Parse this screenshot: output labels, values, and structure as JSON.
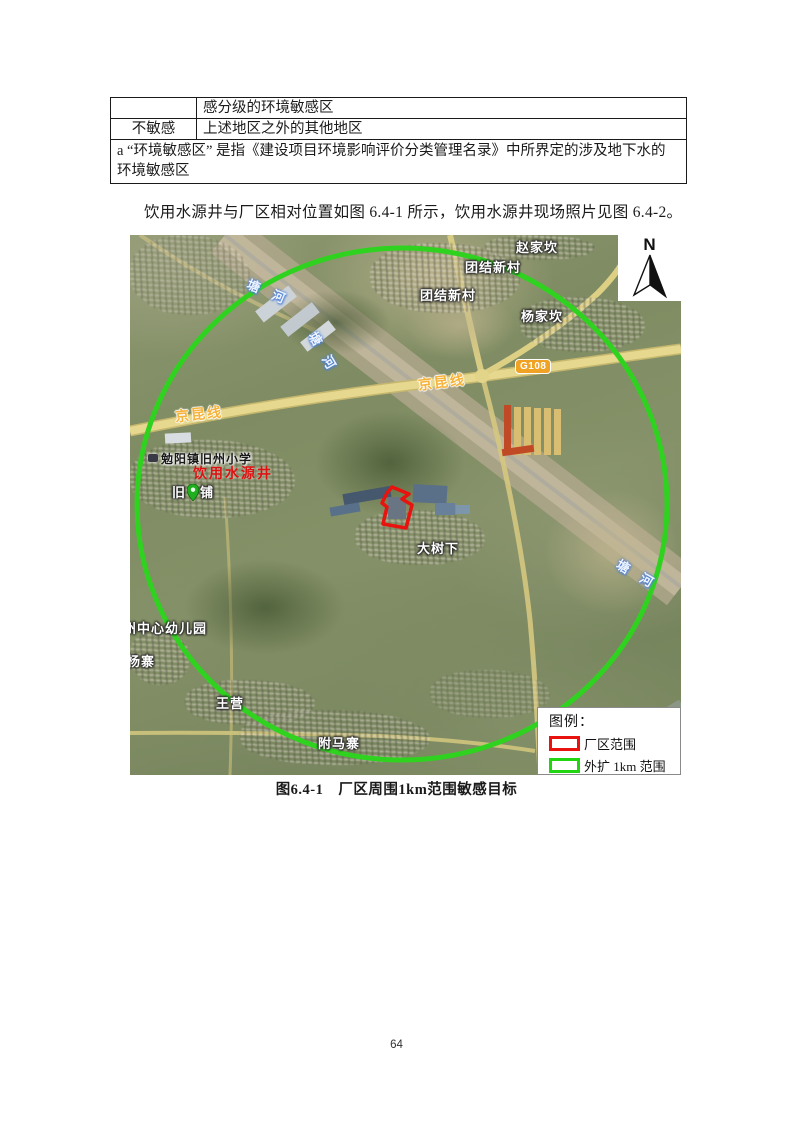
{
  "table": {
    "row1_col1": "",
    "row1_col2": "感分级的环境敏感区",
    "row2_col1": "不敏感",
    "row2_col2": "上述地区之外的其他地区",
    "footnote": "a “环境敏感区” 是指《建设项目环境影响评价分类管理名录》中所界定的涉及地下水的环境敏感区"
  },
  "paragraph": "饮用水源井与厂区相对位置如图 6.4-1 所示，饮用水源井现场照片见图 6.4-2。",
  "figure": {
    "caption": "图6.4-1　厂区周围1km范围敏感目标",
    "north": "N",
    "legend_title": "图例：",
    "legend_items": [
      {
        "label": "厂区范围",
        "color": "#e8120e"
      },
      {
        "label": "外扩 1km 范围",
        "color": "#22d411"
      }
    ],
    "colors": {
      "buffer_circle_green": "#2fd31f",
      "plant_boundary_red": "#e8120e",
      "road_yellow": "#e6d88e",
      "road_label_orange": "#f6b33a",
      "well_label_red": "#dd1111",
      "g108_badge_orange": "#f0a224"
    }
  },
  "map": {
    "labels": {
      "zhaojiakan": "赵家坎",
      "tuanjie1": "团结新村",
      "tuanjie2": "团结新村",
      "yangjiakan": "杨家坎",
      "g108": "G108",
      "jingkun_right": "京昆线",
      "jingkun_left": "京昆线",
      "school": "勉阳镇旧州小学",
      "well": "饮用水源井",
      "jiuzhou_left": "旧",
      "jiuzhou_right": "铺",
      "dashuxia": "大树下",
      "kindergarten": "州中心幼儿园",
      "yangzhai": "杨寨",
      "wangying": "王营",
      "fumazhai": "附马寨",
      "river1": "塘河",
      "river2": "塘河",
      "river3": "塘河"
    }
  },
  "page_number": "64"
}
